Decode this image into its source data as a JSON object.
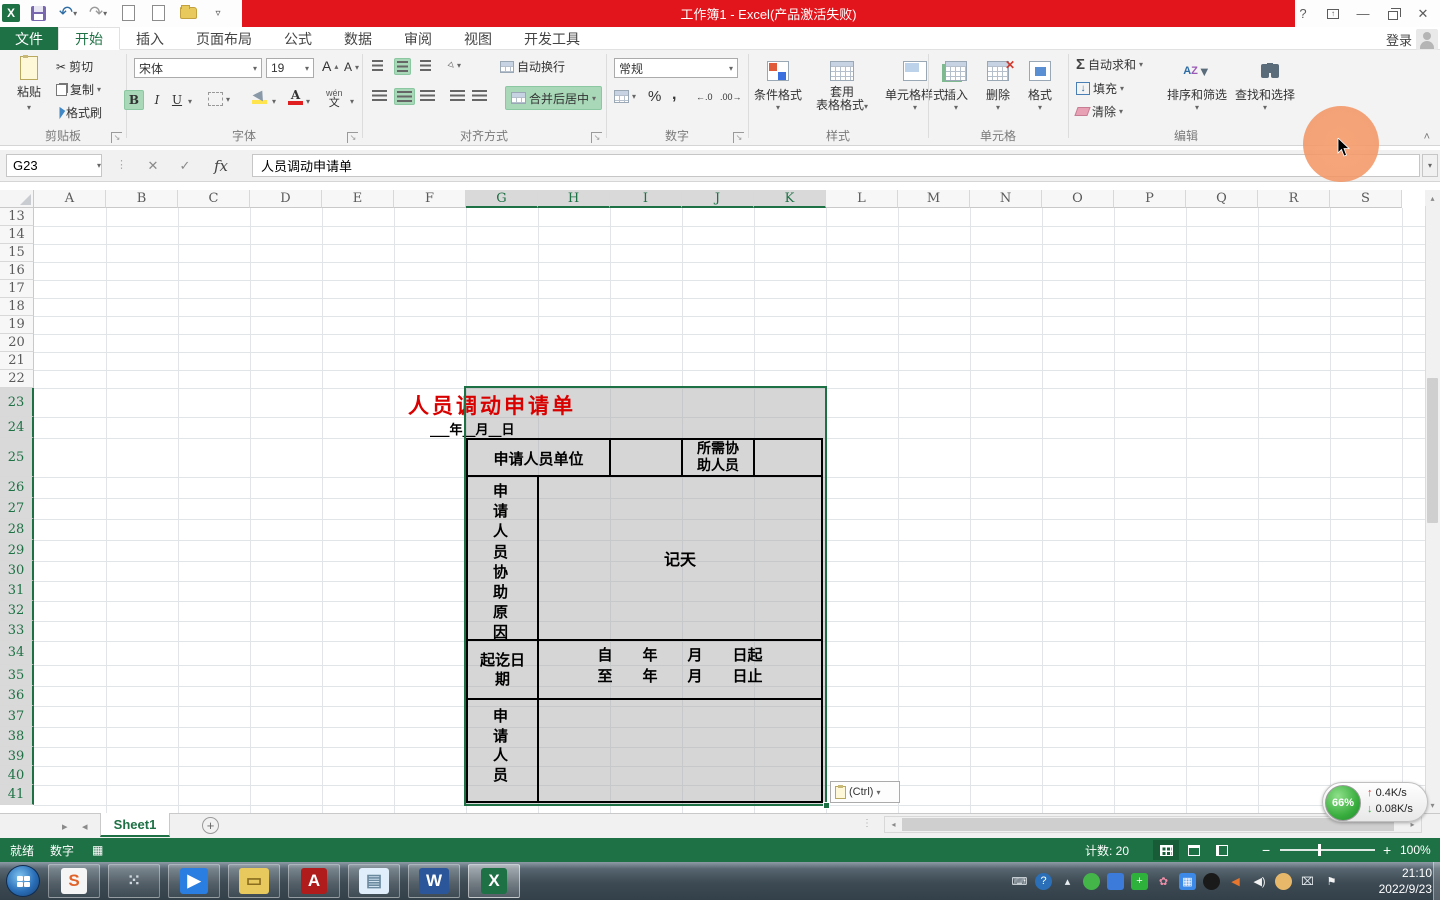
{
  "titlebar": {
    "title": "工作簿1 - Excel(产品激活失败)",
    "signin": "登录"
  },
  "tabs": {
    "file": "文件",
    "items": [
      "开始",
      "插入",
      "页面布局",
      "公式",
      "数据",
      "审阅",
      "视图",
      "开发工具"
    ],
    "active_index": 0
  },
  "ribbon": {
    "clipboard": {
      "group": "剪贴板",
      "paste": "粘贴",
      "cut": "剪切",
      "copy": "复制",
      "painter": "格式刷"
    },
    "font": {
      "group": "字体",
      "name": "宋体",
      "size": "19",
      "pinyin_top": "wén",
      "pinyin_bottom": "文"
    },
    "align": {
      "group": "对齐方式",
      "wrap": "自动换行",
      "merge": "合并后居中"
    },
    "number": {
      "group": "数字",
      "format": "常规"
    },
    "styles": {
      "group": "样式",
      "conditional": "条件格式",
      "table_line1": "套用",
      "table_line2": "表格格式",
      "cellstyle": "单元格样式"
    },
    "cells": {
      "group": "单元格",
      "insert": "插入",
      "del": "删除",
      "format": "格式"
    },
    "edit": {
      "group": "编辑",
      "autosum": "自动求和",
      "fill": "填充",
      "clear": "清除",
      "sort": "排序和筛选",
      "find": "查找和选择"
    }
  },
  "formula_bar": {
    "name_box": "G23",
    "value": "人员调动申请单"
  },
  "sheet": {
    "columns": [
      "A",
      "B",
      "C",
      "D",
      "E",
      "F",
      "G",
      "H",
      "I",
      "J",
      "K",
      "L",
      "M",
      "N",
      "O",
      "P",
      "Q",
      "R",
      "S"
    ],
    "selected_columns": [
      "G",
      "H",
      "I",
      "J",
      "K"
    ],
    "first_row": 13,
    "last_row": 41,
    "selected_from_row": 23
  },
  "form": {
    "title": "人员调动申请单",
    "date_line": "___年__月__日",
    "unit_label": "申请人员单位",
    "assist_label": "所需协助人员",
    "reason_label": "申请人员协助原因",
    "reason_value": "记天",
    "period_label": "起讫日期",
    "from_line": "自　　年　　月　　日起",
    "to_line": "至　　年　　月　　日止",
    "applicant_label": "申请人员",
    "paste_tag": "(Ctrl)"
  },
  "sheet_bar": {
    "active_tab": "Sheet1"
  },
  "status_bar": {
    "ready": "就绪",
    "numlock": "数字",
    "count": "计数: 20",
    "zoom_level": "100%"
  },
  "taskbar": {
    "time": "21:10",
    "date": "2022/9/23",
    "app_icons": [
      {
        "name": "sogou-icon",
        "glyph": "S",
        "bg": "#f5f5f5",
        "fg": "#e0642a"
      },
      {
        "name": "pin-grid-icon",
        "glyph": "⁙",
        "bg": "transparent",
        "fg": "#cfd8de"
      },
      {
        "name": "video-app-icon",
        "glyph": "▶",
        "bg": "#2a7de1",
        "fg": "#ffffff"
      },
      {
        "name": "explorer-icon",
        "glyph": "▭",
        "bg": "#e8c95e",
        "fg": "#8a6d1f"
      },
      {
        "name": "autocad-icon",
        "glyph": "A",
        "bg": "#b01c1c",
        "fg": "#ffffff"
      },
      {
        "name": "notepad-icon",
        "glyph": "▤",
        "bg": "#dfeefa",
        "fg": "#6b8aa0"
      },
      {
        "name": "word-icon",
        "glyph": "W",
        "bg": "#2b579a",
        "fg": "#ffffff"
      },
      {
        "name": "excel-icon",
        "glyph": "X",
        "bg": "#1e7145",
        "fg": "#ffffff"
      }
    ],
    "tray_icons": [
      {
        "name": "keyboard-icon",
        "glyph": "⌨",
        "bg": "transparent",
        "fg": "#e8eef2"
      },
      {
        "name": "help-icon",
        "glyph": "?",
        "bg": "#2a6fb8",
        "fg": "#ffffff"
      },
      {
        "name": "tray-expand-icon",
        "glyph": "▴",
        "bg": "transparent",
        "fg": "#e8eef2"
      },
      {
        "name": "wechat-icon",
        "glyph": "",
        "bg": "#44b549",
        "fg": "#ffffff"
      },
      {
        "name": "input-method-icon",
        "glyph": "",
        "bg": "#3c7bd9",
        "fg": "#ffffff"
      },
      {
        "name": "antivirus-icon",
        "glyph": "+",
        "bg": "#2eb23c",
        "fg": "#ffffff"
      },
      {
        "name": "flower-icon",
        "glyph": "✿",
        "bg": "transparent",
        "fg": "#f08ea8"
      },
      {
        "name": "media-icon",
        "glyph": "▦",
        "bg": "#3c89e8",
        "fg": "#ffffff"
      },
      {
        "name": "qq-icon",
        "glyph": "",
        "bg": "#1a1a1a",
        "fg": "#ffffff"
      },
      {
        "name": "volume-mute-icon",
        "glyph": "◀",
        "bg": "transparent",
        "fg": "#e8762c"
      },
      {
        "name": "volume-icon",
        "glyph": "◀)",
        "bg": "transparent",
        "fg": "#f2f2f2"
      },
      {
        "name": "assistant-icon",
        "glyph": "",
        "bg": "#e8b86a",
        "fg": "#7a5a1f"
      },
      {
        "name": "network-icon",
        "glyph": "⌧",
        "bg": "transparent",
        "fg": "#e8eef2"
      },
      {
        "name": "alert-flag-icon",
        "glyph": "⚑",
        "bg": "transparent",
        "fg": "#f2f2f2"
      }
    ]
  },
  "netball": {
    "percent": "66%",
    "up_speed": "0.4K/s",
    "down_speed": "0.08K/s"
  },
  "icons": {
    "undo": "↶",
    "redo": "↷",
    "preview": "⌕",
    "qat_more": "▿",
    "help": "?",
    "min": "—",
    "close": "✕",
    "cancel": "✕",
    "enter": "✓",
    "fx": "fx",
    "dd": "▾",
    "up": "▴",
    "left": "◂",
    "right": "▸",
    "bold": "B",
    "italic": "I",
    "underline": "U",
    "font_bigger": "A",
    "font_smaller": "A",
    "sum": "Σ",
    "percent": "%",
    "comma": ",",
    "dec_inc": "←.0",
    "dec_dec": ".00→",
    "fill_arrow": "↓",
    "sort_a": "A",
    "sort_z": "Z",
    "funnel": "▼",
    "find_glyph": "⌖",
    "cut_glyph": "✂",
    "orient_glyph": "◇",
    "dialog": "↘",
    "collapse": "˄",
    "minus": "−",
    "plus": "+",
    "macro_glyph": "▦"
  }
}
